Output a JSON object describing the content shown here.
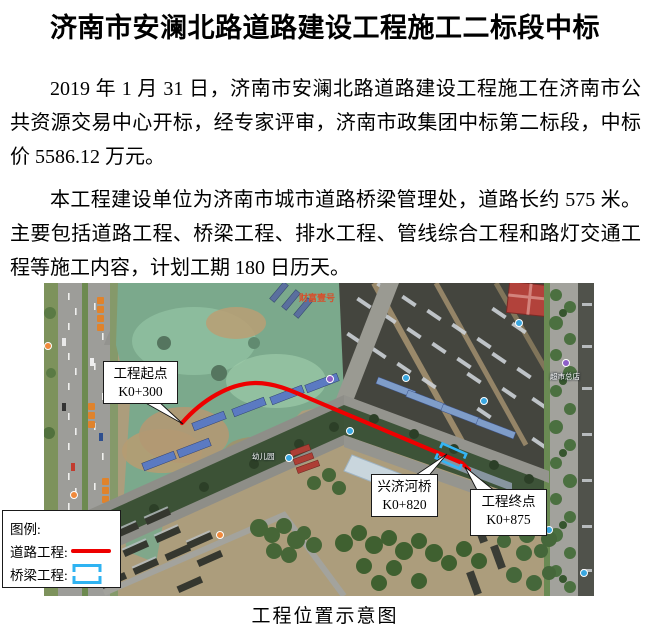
{
  "page": {
    "title": "济南市安澜北路道路建设工程施工二标段中标",
    "paragraphs": [
      "2019 年 1 月 31 日，济南市安澜北路道路建设工程施工在济南市公共资源交易中心开标，经专家评审，济南市政集团中标第二标段，中标价 5586.12 万元。",
      "本工程建设单位为济南市城市道路桥梁管理处，道路长约 575 米。主要包括道路工程、桥梁工程、排水工程、管线综合工程和路灯交通工程等施工内容，计划工期 180 日历天。"
    ],
    "caption": "工程位置示意图"
  },
  "map": {
    "callouts": {
      "start": {
        "line1": "工程起点",
        "line2": "K0+300"
      },
      "bridge": {
        "line1": "兴济河桥",
        "line2": "K0+820"
      },
      "end": {
        "line1": "工程终点",
        "line2": "K0+875"
      }
    },
    "legend": {
      "title": "图例:",
      "road_label": "道路工程:",
      "bridge_label": "桥梁工程:"
    },
    "poi_labels": [
      "财富壹号",
      "幼儿园",
      "超市总店",
      "交苑佳缘小区"
    ],
    "colors": {
      "road_line": "#ee0000",
      "bridge_symbol": "#2fb3f2"
    }
  }
}
